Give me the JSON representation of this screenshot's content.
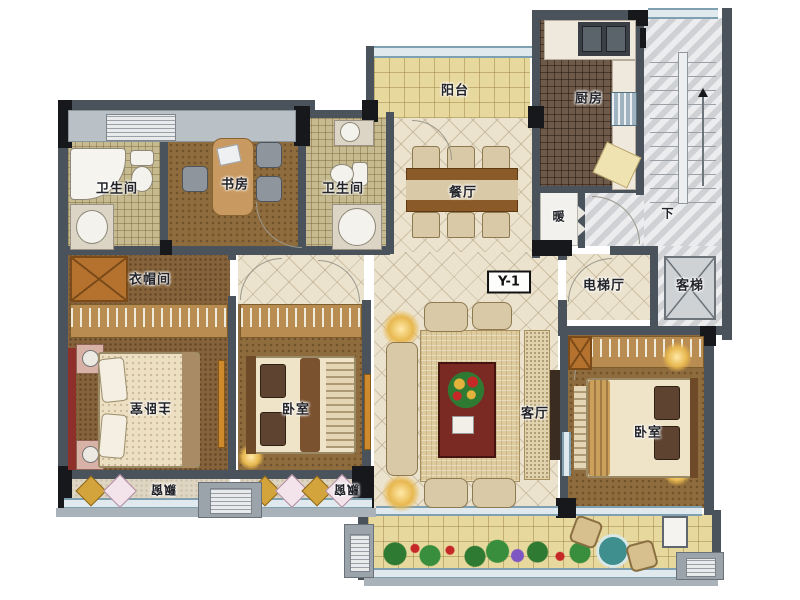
{
  "plan": {
    "code": "Y-1",
    "rooms": {
      "balcony": {
        "label": "阳台"
      },
      "kitchen": {
        "label": "厨房"
      },
      "stairs_down": {
        "label": "下"
      },
      "heater": {
        "label": "暖"
      },
      "bath_left": {
        "label": "卫生间"
      },
      "study": {
        "label": "书房"
      },
      "bath_mid": {
        "label": "卫生间"
      },
      "dining": {
        "label": "餐厅"
      },
      "elevator_hall": {
        "label": "电梯厅"
      },
      "elevator": {
        "label": "客梯"
      },
      "cloakroom": {
        "label": "衣帽间"
      },
      "master_bedroom": {
        "label": "主卧室"
      },
      "bedroom_2": {
        "label": "卧室"
      },
      "living": {
        "label": "客厅"
      },
      "bedroom_3": {
        "label": "卧室"
      },
      "bay_window_master": {
        "label": "飘窗"
      },
      "bay_window_2": {
        "label": "飘窗"
      }
    },
    "colors": {
      "wall": "#4a525c",
      "pillar": "#16181c",
      "wood_floor": "#8f6c3d",
      "tile_cream": "#ece3cf",
      "tile_balcony": "#e7d89e",
      "bath_tile": "#c6ba90",
      "kitchen_floor": "#6f5a49",
      "stair_gray": "#d9dadc",
      "accent_red": "#8e2f2a",
      "window_blue": "#dfe9ee",
      "wardrobe_orange": "#b5722f"
    }
  }
}
